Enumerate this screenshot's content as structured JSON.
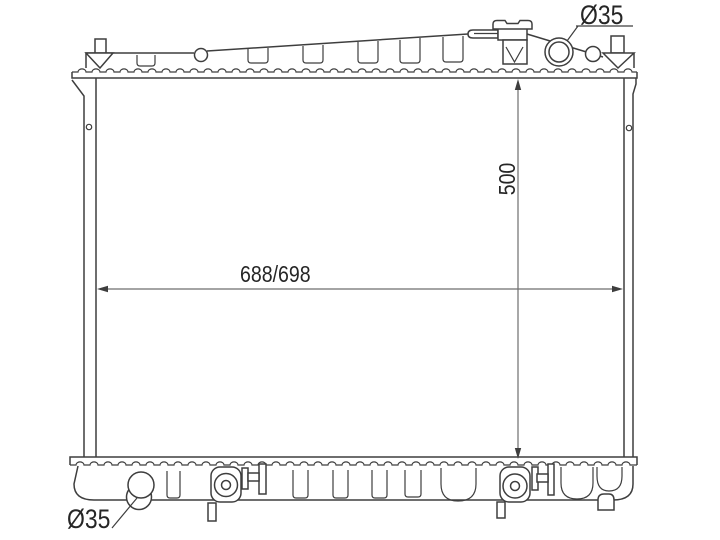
{
  "drawing": {
    "title": "radiator outline drawing",
    "labels": {
      "inlet_diameter": "Ø35",
      "outlet_diameter": "Ø35",
      "height": "500",
      "width": "688/698"
    },
    "colors": {
      "background": "#ffffff",
      "line": "#3e3e3e",
      "dimension_line": "#6e6e6e",
      "text": "#262626"
    }
  }
}
